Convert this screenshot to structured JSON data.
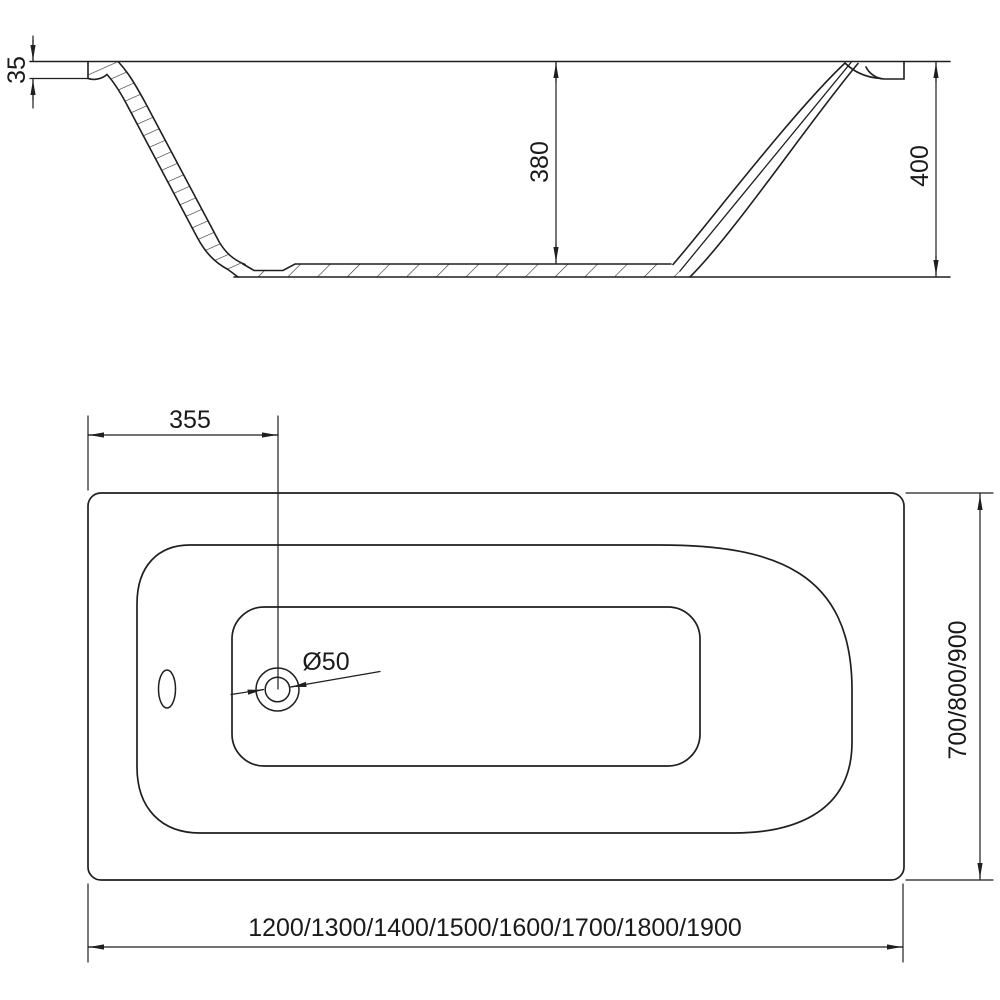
{
  "section_view": {
    "rim_height_label": "35",
    "inner_depth_label": "380",
    "overall_height_label": "400"
  },
  "plan_view": {
    "drain_offset_label": "355",
    "drain_diameter_label": "Ø50",
    "length_options_label": "1200/1300/1400/1500/1600/1700/1800/1900",
    "width_options_label": "700/800/900"
  },
  "colors": {
    "line": "#1f1f1f",
    "hatch": "#2b2b2b",
    "background": "#ffffff"
  }
}
